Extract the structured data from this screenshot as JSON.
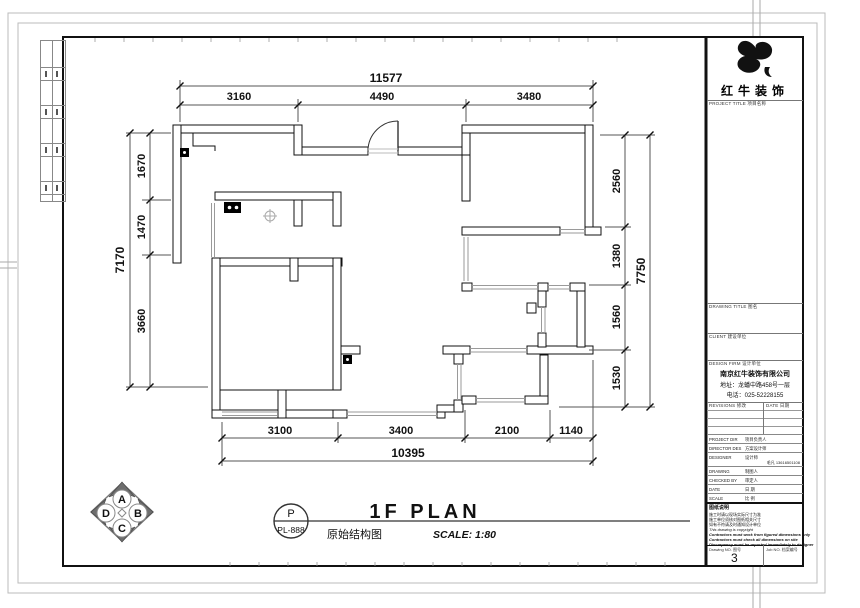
{
  "dimensions": {
    "top_total": "11577",
    "top": [
      "3160",
      "4490",
      "3480"
    ],
    "left": [
      "1670",
      "1470",
      "3660"
    ],
    "left_total": "7170",
    "right": [
      "2560",
      "1380",
      "1560",
      "1530"
    ],
    "right_total": "7750",
    "bottom": [
      "3100",
      "3400",
      "2100",
      "1140"
    ],
    "bottom_total": "10395"
  },
  "title_area": {
    "stamp_top": "P",
    "stamp_bottom": "PL-888",
    "drawing_name_cn": "原始结构图",
    "plan_title": "1F PLAN",
    "scale_text": "SCALE: 1:80"
  },
  "compass": {
    "top": "A",
    "right": "B",
    "bottom": "C",
    "left": "D"
  },
  "titleblock": {
    "brand": "红牛装饰",
    "project_label": "PROJECT TITLE 项目名称",
    "drawing_title_label": "DRAWING TITLE 图名",
    "client_label": "CLIENT 建设单位",
    "design_firm_label": "DESIGN FIRM 设计单位",
    "firm_name": "南京红牛装饰有限公司",
    "firm_address": "地址：龙蟠中路458号一层",
    "firm_phone": "电话：025-52228155",
    "revisions_label": "REVISIONS 修改",
    "date_col_label": "DATE 日期",
    "rows": [
      {
        "en": "PROJECT DIR",
        "cn": "项目负责人",
        "val": ""
      },
      {
        "en": "DIRECTOR DES",
        "cn": "方案设计师",
        "val": ""
      },
      {
        "en": "DESIGNER",
        "cn": "设计师",
        "val": "毛凡 13616501108"
      },
      {
        "en": "DRAWING",
        "cn": "制图人",
        "val": ""
      },
      {
        "en": "CHECKED BY",
        "cn": "审定人",
        "val": ""
      },
      {
        "en": "DATE",
        "cn": "日 期",
        "val": ""
      },
      {
        "en": "SCALE",
        "cn": "比 例",
        "val": ""
      }
    ],
    "notes_title": "图纸说明",
    "notes": [
      "施工时请以现场实际尺寸为准",
      "施工单位须核对图纸相关尺寸",
      "如有不符请及时通知设计单位",
      "This drawing is copyright",
      "Contractors must work from figured dimensions only",
      "Contractors must check all dimensions on site",
      "Discrepancy must be reported immediately to designer"
    ],
    "drawing_no_label": "Drawing NO. 图号",
    "drawing_no": "3",
    "job_no_label": "Job NO. 档案编号"
  }
}
